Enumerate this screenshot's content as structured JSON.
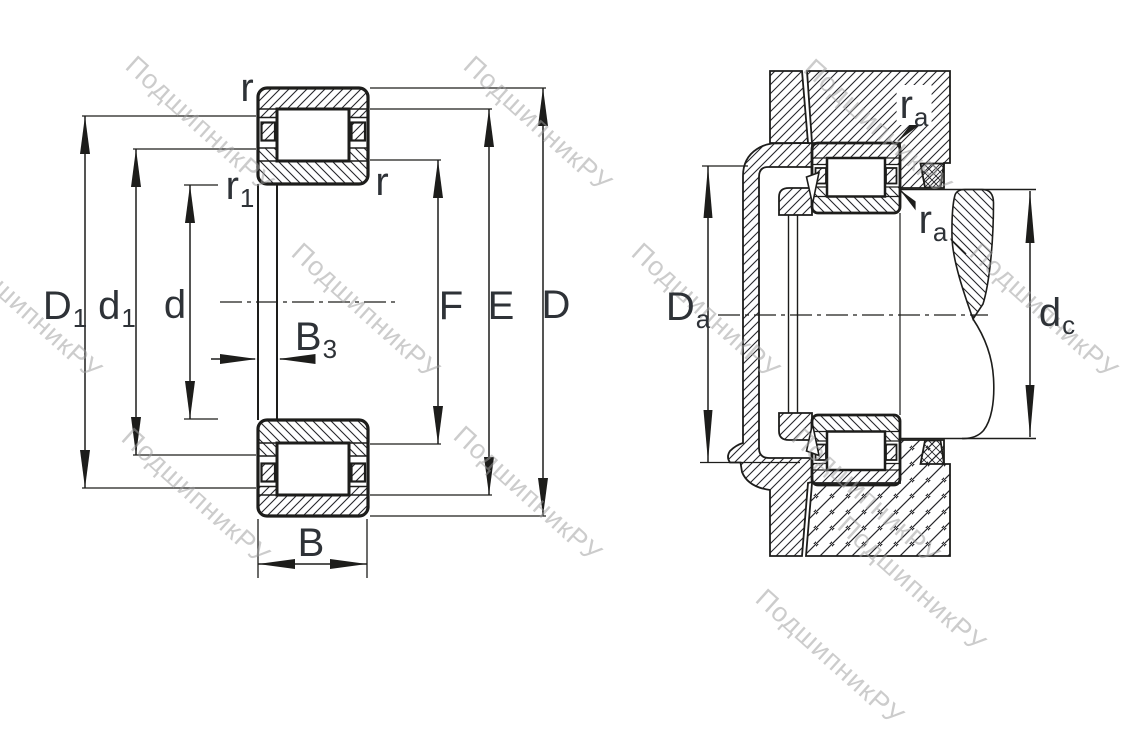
{
  "watermark": {
    "text": "ПодшипникРУ"
  },
  "colors": {
    "line": "#1d1d1b",
    "label": "#2e3237",
    "watermark": "#9e9e9e",
    "background": "#ffffff"
  },
  "left_figure": {
    "description": "cylindrical roller bearing cross-section with boundary dimensions",
    "dimension_labels": {
      "r_top": {
        "main": "r",
        "sub": ""
      },
      "r_inner": {
        "main": "r",
        "sub": ""
      },
      "r1": {
        "main": "r",
        "sub": "1"
      },
      "D1": {
        "main": "D",
        "sub": "1"
      },
      "d1": {
        "main": "d",
        "sub": "1"
      },
      "d": {
        "main": "d",
        "sub": ""
      },
      "B3": {
        "main": "B",
        "sub": "3"
      },
      "B": {
        "main": "B",
        "sub": ""
      },
      "F": {
        "main": "F",
        "sub": ""
      },
      "E": {
        "main": "E",
        "sub": ""
      },
      "D": {
        "main": "D",
        "sub": ""
      }
    }
  },
  "right_figure": {
    "description": "bearing mounting arrangement with abutment dimensions",
    "dimension_labels": {
      "ra_housing": {
        "main": "r",
        "sub": "a"
      },
      "ra_shaft": {
        "main": "r",
        "sub": "a"
      },
      "Da": {
        "main": "D",
        "sub": "a"
      },
      "dc": {
        "main": "d",
        "sub": "c"
      }
    }
  }
}
